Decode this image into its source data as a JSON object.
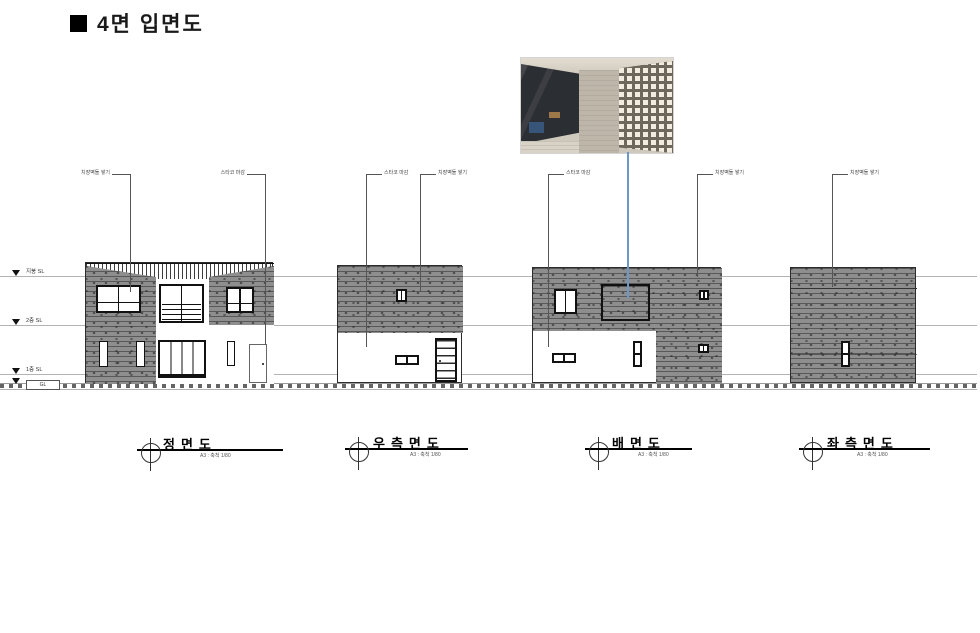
{
  "header": {
    "title": "4면 입면도"
  },
  "levels": [
    {
      "label": "지붕 SL"
    },
    {
      "label": "2층 SL"
    },
    {
      "label": "1층 SL"
    },
    {
      "label": "GL"
    }
  ],
  "annotations": [
    {
      "text": "치장벽돌 쌓기"
    },
    {
      "text": "스타코 마감"
    },
    {
      "text": "스타코 마감"
    },
    {
      "text": "치장벽돌 쌓기"
    },
    {
      "text": "스타코 마감"
    },
    {
      "text": "치장벽돌 쌓기"
    },
    {
      "text": "치장벽돌 쌓기"
    }
  ],
  "elevations": [
    {
      "id": "front",
      "label": "정면도",
      "scale": "A3 : 축척 1/80"
    },
    {
      "id": "right",
      "label": "우측면도",
      "scale": "A3 : 축척 1/80"
    },
    {
      "id": "rear",
      "label": "배면도",
      "scale": "A3 : 축척 1/80"
    },
    {
      "id": "left",
      "label": "좌측면도",
      "scale": "A3 : 축척 1/80"
    }
  ],
  "colors": {
    "brick": "#8e8e8e",
    "leader_blue": "#6b97c9",
    "datum_line": "#b3b3b3",
    "ink": "#111111"
  }
}
